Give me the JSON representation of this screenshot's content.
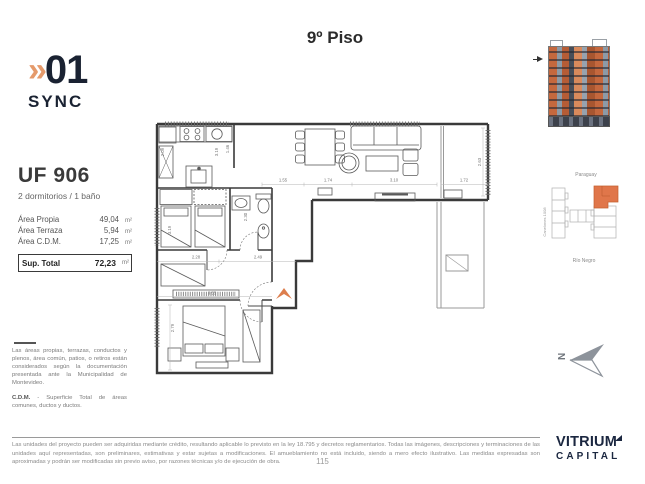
{
  "brand": {
    "chevrons": "»",
    "number": "01",
    "sub": "SYNC"
  },
  "page_title": "9º Piso",
  "unit_card": {
    "code": "UF 906",
    "subtitle": "2 dormitorios / 1 baño",
    "rows": [
      {
        "label": "Área Propia",
        "value": "49,04",
        "unit": "m²"
      },
      {
        "label": "Área Terraza",
        "value": "5,94",
        "unit": "m²"
      },
      {
        "label": "Área C.D.M.",
        "value": "17,25",
        "unit": "m²"
      }
    ],
    "total_label": "Sup. Total",
    "total_value": "72,23",
    "total_unit": "m²"
  },
  "notes": {
    "paragraph": "Las áreas propias, terrazas, conductos y plenos, área común, patios, o retiros están considerados según la documentación presentada ante la Municipalidad de Montevideo.",
    "cdm_term": "C.D.M.",
    "cdm_text": " - Superficie Total de áreas comunes, ductos y ductos."
  },
  "plan": {
    "north": "N",
    "entry_arrow_color": "#DD7E4D",
    "dims": {
      "kitchen_depth": "2.09",
      "kitchen_width": "3.19",
      "kitchen_inner": "1.46",
      "top_w1": "1.55",
      "top_w2": "1.74",
      "top_w3": "3.10",
      "terrace_w": "1.72",
      "terrace_d": "2.63",
      "bed1_depth": "3.19",
      "bath_depth": "2.30",
      "hall_w1": "2.28",
      "hall_w2": "2.49",
      "bed2_w": "3.55",
      "bed2_d": "2.79"
    }
  },
  "key_map": {
    "street_top": "Paraguay",
    "street_bottom": "Río Negro",
    "street_left": "Canelones 1008",
    "unit_color": "#E0764A"
  },
  "footer": {
    "line1": "Las unidades del proyecto pueden ser adquiridas mediante crédito, resultando aplicable lo previsto en la ley 18.795 y decretos reglamentarios. Todas las imágenes, descripciones y terminaciones de las unidades aquí representadas, son preliminares,",
    "line2": "estimativas y estar sujetas a modificaciones. El amueblamiento no está incluido, siendo a mero efecto ilustrativo. Las medidas expresadas son aproximadas y podrán ser modificadas sin previo aviso, por razones técnicas y/o de ejecución de obra.",
    "page_number": "115",
    "brand_line1": "VITRIUM",
    "brand_line2": "CAPITAL"
  }
}
